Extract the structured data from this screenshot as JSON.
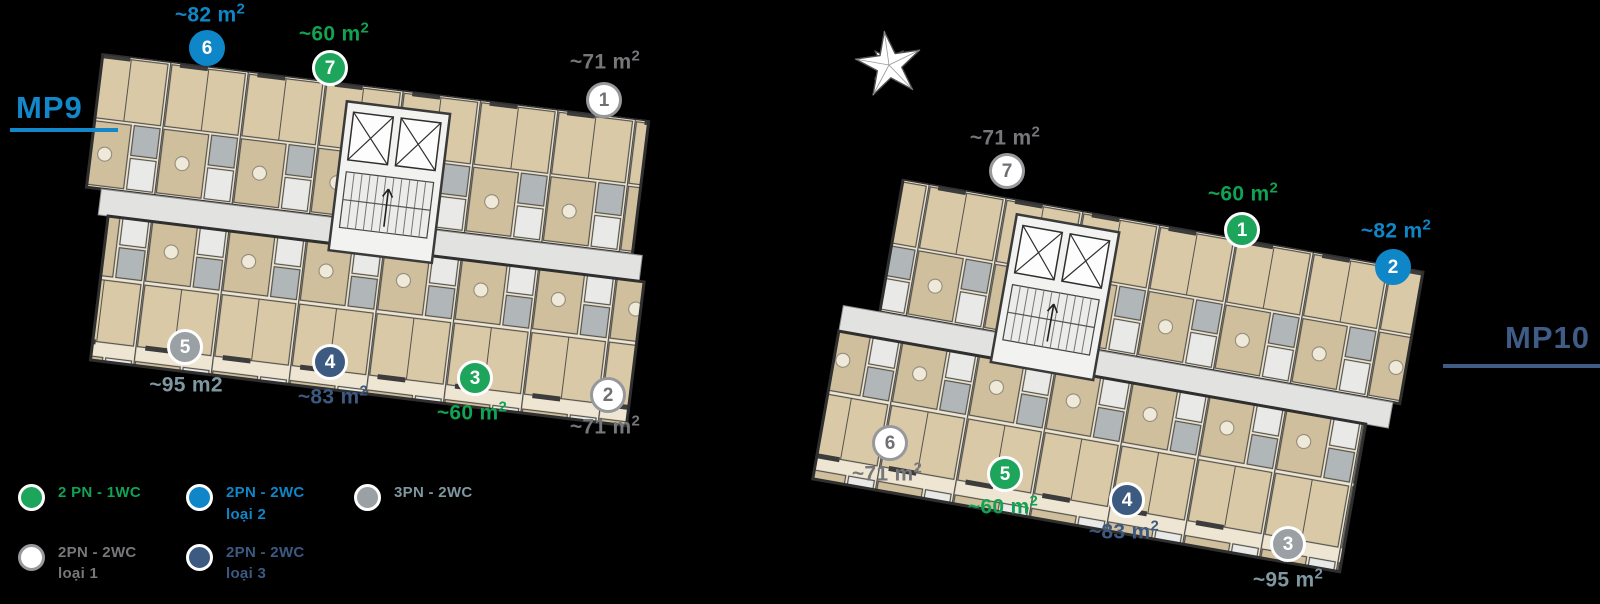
{
  "page": {
    "background": "#000000"
  },
  "unit_types": {
    "green": {
      "circle": "#1da55c",
      "ring": "#ffffff",
      "number": "#ffffff",
      "text": "#0fa352"
    },
    "blue": {
      "circle": "#0e86c7",
      "ring": "#0e86c7",
      "number": "#ffffff",
      "text": "#0e86c7"
    },
    "white": {
      "circle": "#ffffff",
      "ring": "#97989b",
      "number": "#6f7073",
      "text": "#76777a"
    },
    "navy": {
      "circle": "#3d5a80",
      "ring": "#ffffff",
      "number": "#ffffff",
      "text": "#3c5a81"
    },
    "slate": {
      "circle": "#9aa0a4",
      "ring": "#ffffff",
      "number": "#ffffff",
      "text": "#7e97a0"
    }
  },
  "buildings": [
    {
      "id": "mp9",
      "title": "MP9",
      "title_color": "#1287c9",
      "units": [
        {
          "num": "6",
          "type": "blue",
          "area": "~82 m",
          "sup": "2",
          "cx": 207,
          "cy": 48,
          "lx": 210,
          "ly": 15
        },
        {
          "num": "7",
          "type": "green",
          "area": "~60 m",
          "sup": "2",
          "cx": 330,
          "cy": 68,
          "lx": 334,
          "ly": 34
        },
        {
          "num": "1",
          "type": "white",
          "area": "~71 m",
          "sup": "2",
          "cx": 604,
          "cy": 100,
          "lx": 605,
          "ly": 62
        },
        {
          "num": "5",
          "type": "slate",
          "area": "~95 m2",
          "sup": "",
          "cx": 185,
          "cy": 347,
          "lx": 186,
          "ly": 385
        },
        {
          "num": "4",
          "type": "navy",
          "area": "~83 m",
          "sup": "2",
          "cx": 330,
          "cy": 362,
          "lx": 333,
          "ly": 397
        },
        {
          "num": "3",
          "type": "green",
          "area": "~60 m",
          "sup": "2",
          "cx": 475,
          "cy": 378,
          "lx": 472,
          "ly": 413
        },
        {
          "num": "2",
          "type": "white",
          "area": "~71 m",
          "sup": "2",
          "cx": 608,
          "cy": 395,
          "lx": 605,
          "ly": 427
        }
      ]
    },
    {
      "id": "mp10",
      "title": "MP10",
      "title_color": "#3e5c86",
      "units": [
        {
          "num": "7",
          "type": "white",
          "area": "~71 m",
          "sup": "2",
          "cx": 1007,
          "cy": 171,
          "lx": 1005,
          "ly": 138
        },
        {
          "num": "1",
          "type": "green",
          "area": "~60 m",
          "sup": "2",
          "cx": 1242,
          "cy": 230,
          "lx": 1243,
          "ly": 194
        },
        {
          "num": "2",
          "type": "blue",
          "area": "~82 m",
          "sup": "2",
          "cx": 1393,
          "cy": 267,
          "lx": 1396,
          "ly": 231
        },
        {
          "num": "6",
          "type": "white",
          "area": "~71 m",
          "sup": "2",
          "cx": 890,
          "cy": 443,
          "lx": 887,
          "ly": 474
        },
        {
          "num": "5",
          "type": "green",
          "area": "~60 m",
          "sup": "2",
          "cx": 1005,
          "cy": 474,
          "lx": 1003,
          "ly": 507
        },
        {
          "num": "4",
          "type": "navy",
          "area": "~83 m",
          "sup": "2",
          "cx": 1127,
          "cy": 500,
          "lx": 1124,
          "ly": 532
        },
        {
          "num": "3",
          "type": "slate",
          "area": "~95 m",
          "sup": "2",
          "cx": 1288,
          "cy": 544,
          "lx": 1288,
          "ly": 580
        }
      ]
    }
  ],
  "legend": {
    "items": [
      {
        "type": "green",
        "label": "2 PN - 1WC",
        "sub": ""
      },
      {
        "type": "blue",
        "label": "2PN - 2WC",
        "sub": "loại 2"
      },
      {
        "type": "slate",
        "label": "3PN - 2WC",
        "sub": ""
      },
      {
        "type": "white",
        "label": "2PN - 2WC",
        "sub": "loại 1"
      },
      {
        "type": "navy",
        "label": "2PN - 2WC",
        "sub": "loại 3"
      }
    ]
  },
  "compass": {
    "name": "compass-star"
  }
}
